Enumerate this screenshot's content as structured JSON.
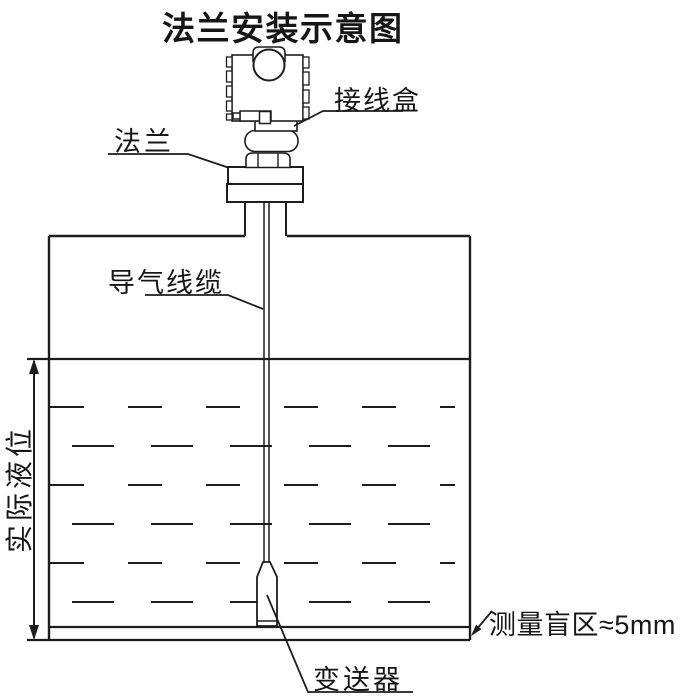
{
  "title": "法兰安装示意图",
  "labels": {
    "flange": "法兰",
    "junction_box": "接线盒",
    "air_cable": "导气线缆",
    "actual_level": "实际液位",
    "transmitter": "变送器",
    "blind_zone": "测量盲区≈5mm"
  },
  "diagram_parts": {
    "tank": "储罐",
    "probe": "探头",
    "cable": "悬挂线缆"
  },
  "colors": {
    "line": "#1d1d1d",
    "background": "#ffffff"
  }
}
